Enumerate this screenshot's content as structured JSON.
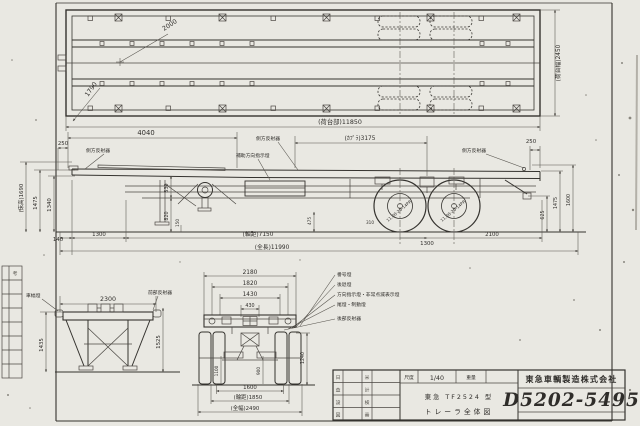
{
  "top_view": {
    "r2000": "2000",
    "r1790": "1790",
    "bed_length": "(荷台部)11850",
    "bed_width": "(荷台幅)2450"
  },
  "side_view": {
    "labels": {
      "side_reflector": "側方反射器",
      "aux_turn_signal": "補助方向指示燈"
    },
    "dims": {
      "front_250": "250",
      "d4040": "4040",
      "d3175": "(ｶﾌﾟﾗ)3175",
      "rear_250": "250",
      "floor_height": "(床高)1690",
      "h1475": "1475",
      "h1340": "1340",
      "h530": "530",
      "h820": "820",
      "clearance_150": "150",
      "h475": "475",
      "d310": "310",
      "h625": "625",
      "rear_1475": "1475",
      "rear_1600": "1600",
      "d140": "140",
      "left_1300": "1300",
      "wheelbase": "(軸距)7150",
      "axle_1300": "1300",
      "rear_2100": "2100",
      "overall_length": "(全長)11990"
    },
    "tire": "11.00-20-14PR"
  },
  "front_view": {
    "dims": {
      "w2300": "2300",
      "h1435": "1435",
      "h1525": "1525"
    },
    "labels": {
      "width_lamp": "車幅燈",
      "front_reflector": "前部反射器"
    }
  },
  "rear_view": {
    "dims": {
      "w2180": "2180",
      "w1820": "1820",
      "w1430": "1430",
      "w430": "430",
      "w1100": "1100",
      "w900": "900",
      "h1240": "1240",
      "w1600": "1600",
      "track": "(輪距)1850",
      "overall_width": "(全幅)2490"
    },
    "labels": [
      "番号燈",
      "後退燈",
      "方向指示燈・非常点滅表示燈",
      "尾燈・制動燈",
      "後部反射器"
    ]
  },
  "title_block": {
    "scale_label": "尺度",
    "scale_value": "1/40",
    "weight_label": "重量",
    "model": "東急 TF2524 型",
    "drawing_title": "トレーラ全体図",
    "company": "東急車輌製造株式会社",
    "drawing_number": "D5202-5495",
    "signoff_col1": [
      "日",
      "査",
      "設",
      "図"
    ],
    "signoff_col2": [
      "米",
      "計",
      "検",
      "番"
    ]
  },
  "margin": {
    "strip_header": "考"
  }
}
